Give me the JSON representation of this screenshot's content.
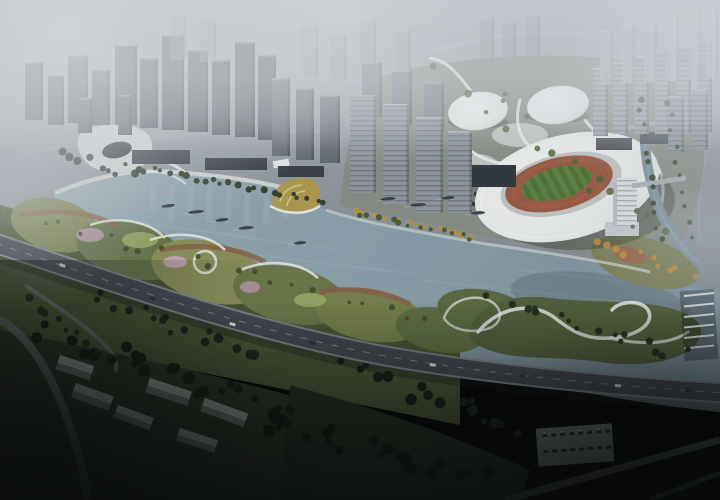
{
  "meta": {
    "description": "Aerial dusk rendering of a riverfront masterplan: foggy high-rise city, white oval stadium with running track, two white domes, river with boats, curvy park mounds, elevated highway, dark forest and village",
    "visible_text": ""
  },
  "palette": {
    "city_ground_top": "#a9b0b6",
    "city_ground_bottom": "#7e868d",
    "water_light": "#98aab2",
    "water_deep": "#7b909b",
    "peninsula": "#878e85",
    "stadium_white": "#eef1f0",
    "track_red": "#9a5a43",
    "field_green": "#50733a",
    "dome_white": "#f2f5f4",
    "highway_asphalt": "#43484f",
    "highway_edge": "#7b848b",
    "road_light": "#a8afb5",
    "promenade_white": "#dfe3e2",
    "park_base": "#4a5433",
    "park_olive": "#7d8551",
    "park_green": "#66744a",
    "park_yellowgreen": "#9db06a",
    "park_pink": "#b398a4",
    "park_rust": "#8a5f46",
    "island_green": "#515f3a",
    "forest_dark": "#131a11",
    "dark_park": "#2c3424",
    "gold_fan": "#ad9a4f",
    "plaza_white": "#dcdfdd",
    "canal_water": "#7e929c",
    "pier_white": "#dce1e1",
    "boat_dark": "#39424a",
    "house_roof": "#a2aaa5",
    "house_wall": "#6f7874",
    "parking_gray": "#878f8c",
    "car_dark": "#23282b",
    "fog_white": "#dfe3e6",
    "vignette_dark": "#070a08"
  },
  "towers": {
    "clusters": [
      {
        "name": "downtown-dark-west",
        "color": "#4a5158",
        "opacity": 1,
        "bands": false,
        "towers": [
          [
            25,
            62,
            18,
            58
          ],
          [
            48,
            75,
            16,
            50
          ],
          [
            68,
            55,
            20,
            68
          ],
          [
            92,
            70,
            18,
            55
          ],
          [
            115,
            45,
            22,
            80
          ],
          [
            140,
            58,
            18,
            70
          ],
          [
            162,
            35,
            22,
            95
          ],
          [
            188,
            50,
            20,
            82
          ],
          [
            212,
            60,
            18,
            75
          ],
          [
            235,
            42,
            20,
            95
          ],
          [
            258,
            55,
            18,
            85
          ],
          [
            118,
            95,
            14,
            40
          ],
          [
            78,
            98,
            14,
            35
          ]
        ]
      },
      {
        "name": "midtown-haze-row",
        "color": "#8a939a",
        "opacity": 0.5,
        "bands": false,
        "towers": [
          [
            170,
            15,
            16,
            45
          ],
          [
            200,
            20,
            16,
            42
          ],
          [
            300,
            25,
            18,
            50
          ],
          [
            330,
            35,
            16,
            45
          ],
          [
            360,
            20,
            16,
            50
          ],
          [
            395,
            30,
            16,
            45
          ],
          [
            480,
            18,
            14,
            40
          ],
          [
            502,
            22,
            14,
            38
          ],
          [
            526,
            15,
            14,
            42
          ]
        ]
      },
      {
        "name": "midtown-gray",
        "color": "#5e656c",
        "opacity": 1,
        "bands": false,
        "towers": [
          [
            272,
            78,
            18,
            78
          ],
          [
            296,
            88,
            18,
            72
          ],
          [
            320,
            95,
            20,
            68
          ]
        ]
      },
      {
        "name": "riverfront-residential-back",
        "color": "#747c83",
        "opacity": 0.9,
        "bands": false,
        "towers": [
          [
            362,
            62,
            20,
            55
          ],
          [
            392,
            70,
            20,
            55
          ],
          [
            424,
            82,
            20,
            50
          ]
        ]
      },
      {
        "name": "riverfront-residential-front",
        "color": "#8e969d",
        "opacity": 1,
        "bands": true,
        "towers": [
          [
            350,
            95,
            26,
            98
          ],
          [
            383,
            104,
            26,
            100
          ],
          [
            416,
            117,
            27,
            96
          ],
          [
            448,
            131,
            24,
            82
          ]
        ]
      },
      {
        "name": "east-slab-row-front",
        "color": "#99a2a9",
        "opacity": 1,
        "bands": true,
        "towers": [
          [
            593,
            68,
            15,
            68
          ],
          [
            613,
            62,
            15,
            72
          ],
          [
            634,
            56,
            15,
            78
          ],
          [
            655,
            50,
            15,
            84
          ],
          [
            676,
            45,
            15,
            88
          ],
          [
            697,
            40,
            15,
            92
          ]
        ]
      },
      {
        "name": "east-slab-row-back",
        "color": "#aab2b8",
        "opacity": 0.75,
        "bands": false,
        "towers": [
          [
            600,
            30,
            13,
            55
          ],
          [
            622,
            25,
            13,
            58
          ],
          [
            644,
            20,
            13,
            62
          ],
          [
            666,
            15,
            13,
            66
          ],
          [
            688,
            10,
            13,
            70
          ],
          [
            706,
            8,
            12,
            70
          ]
        ]
      },
      {
        "name": "east-mid-pair",
        "color": "#8d959c",
        "opacity": 0.9,
        "bands": true,
        "towers": [
          [
            668,
            96,
            16,
            56
          ],
          [
            692,
            90,
            16,
            60
          ]
        ]
      }
    ]
  },
  "podiums": [
    [
      132,
      150,
      58,
      14,
      "#3a4046"
    ],
    [
      205,
      158,
      62,
      12,
      "#363c42"
    ],
    [
      278,
      166,
      46,
      11,
      "#3a4046"
    ],
    [
      470,
      165,
      46,
      22,
      "#31383d"
    ],
    [
      596,
      138,
      36,
      12,
      "#454c52"
    ],
    [
      640,
      132,
      30,
      12,
      "#4a5158"
    ]
  ],
  "tree_strips": [
    [
      128,
      166,
      325,
      200,
      24,
      2.8,
      3,
      3,
      "#2f3b27",
      0.95,
      1
    ],
    [
      355,
      212,
      470,
      236,
      16,
      2.6,
      3,
      2,
      "#b9953f",
      0.95,
      2
    ],
    [
      360,
      215,
      472,
      238,
      12,
      2.4,
      4,
      2,
      "#43552f",
      0.9,
      3
    ],
    [
      455,
      70,
      660,
      240,
      18,
      3.0,
      30,
      14,
      "#4e6338",
      0.85,
      4
    ],
    [
      495,
      300,
      680,
      355,
      16,
      3.2,
      10,
      6,
      "#1f2b1a",
      0.95,
      5
    ],
    [
      640,
      100,
      660,
      240,
      12,
      2.5,
      3,
      3,
      "#33402a",
      0.9,
      6
    ],
    [
      668,
      100,
      690,
      235,
      10,
      2.5,
      3,
      3,
      "#3a4a2e",
      0.85,
      7
    ],
    [
      600,
      240,
      690,
      275,
      10,
      3.0,
      7,
      4,
      "#bf8b3a",
      0.9,
      8
    ],
    [
      20,
      215,
      430,
      320,
      20,
      2.5,
      12,
      6,
      "#3c4a2c",
      0.85,
      9
    ],
    [
      60,
      150,
      130,
      176,
      8,
      3.5,
      6,
      4,
      "#242e20",
      0.9,
      10
    ],
    [
      40,
      330,
      300,
      420,
      26,
      5,
      16,
      10,
      "#131a11",
      1,
      11
    ],
    [
      90,
      300,
      260,
      350,
      16,
      4,
      12,
      8,
      "#1a2217",
      1,
      12
    ],
    [
      260,
      420,
      480,
      480,
      20,
      5,
      18,
      9,
      "#10160e",
      1,
      13
    ],
    [
      330,
      360,
      520,
      430,
      18,
      4.5,
      16,
      9,
      "#161d13",
      1,
      14
    ],
    [
      30,
      300,
      120,
      360,
      10,
      3.5,
      6,
      5,
      "#1e2819",
      1,
      15
    ]
  ],
  "boats": [
    [
      168,
      206,
      14,
      -8
    ],
    [
      196,
      212,
      16,
      -6
    ],
    [
      222,
      220,
      13,
      -8
    ],
    [
      246,
      228,
      15,
      -5
    ],
    [
      300,
      243,
      12,
      -5
    ],
    [
      388,
      199,
      15,
      -5
    ],
    [
      418,
      205,
      16,
      -4
    ],
    [
      448,
      198,
      13,
      -6
    ],
    [
      478,
      213,
      14,
      -4
    ]
  ],
  "houses": [
    [
      60,
      355,
      36,
      15,
      18
    ],
    [
      76,
      383,
      40,
      15,
      20
    ],
    [
      150,
      378,
      44,
      15,
      18
    ],
    [
      205,
      398,
      46,
      14,
      20
    ],
    [
      118,
      405,
      38,
      13,
      20
    ],
    [
      180,
      428,
      40,
      13,
      18
    ]
  ],
  "highway_cars": [
    [
      60,
      263,
      20,
      "#e8ecec"
    ],
    [
      150,
      296,
      18,
      "#2c3236"
    ],
    [
      230,
      322,
      14,
      "#dfe3e3"
    ],
    [
      310,
      341,
      11,
      "#2c3236"
    ],
    [
      430,
      363,
      8,
      "#e8ecec"
    ],
    [
      520,
      374,
      6,
      "#343a3e"
    ],
    [
      615,
      384,
      4,
      "#dfe3e3"
    ],
    [
      685,
      389,
      3,
      "#2c3236"
    ]
  ],
  "parking_cars": {
    "x0": 543,
    "y0": 432,
    "cols": 8,
    "rows": 2,
    "dx": 9,
    "dy": 16,
    "w": 5,
    "h": 3,
    "color": "#23282b"
  },
  "pier": {
    "x": 684,
    "y": 296,
    "n": 6,
    "dy": 10.5,
    "len": 30,
    "drop": -3,
    "color": "#dce1e1"
  },
  "reflections": {
    "x0": 150,
    "n": 9,
    "dx": 19,
    "y": 186,
    "h": 34,
    "w": 6,
    "color": "#ffffff",
    "opacity": 0.07
  }
}
